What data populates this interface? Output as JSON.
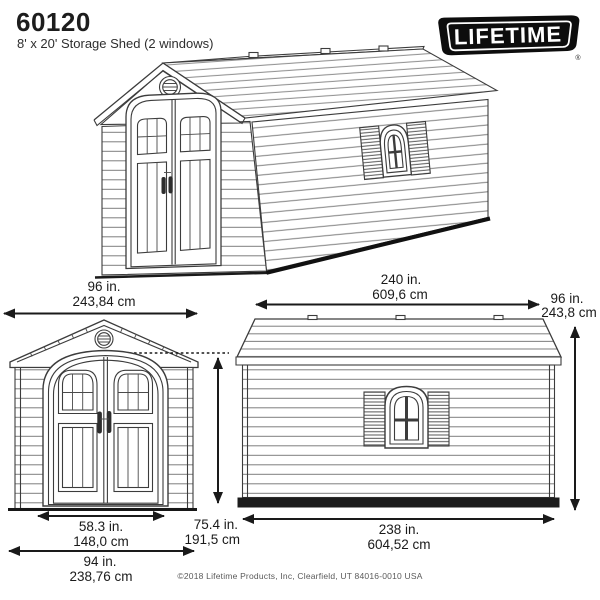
{
  "header": {
    "model_number": "60120",
    "product_name": "8' x 20' Storage Shed (2 windows)",
    "brand_logo_text": "LIFETIME",
    "registered_symbol": "®"
  },
  "views": {
    "perspective": {
      "front_width": {
        "inches": "96 in.",
        "centimeters": "243,84 cm"
      },
      "side_length": {
        "inches": "240 in.",
        "centimeters": "609,6 cm"
      }
    },
    "front_elevation": {
      "door_width": {
        "inches": "58.3 in.",
        "centimeters": "148,0 cm"
      },
      "door_height": {
        "inches": "75.4 in.",
        "centimeters": "191,5 cm"
      },
      "base_width": {
        "inches": "94 in.",
        "centimeters": "238,76 cm"
      }
    },
    "side_elevation": {
      "height": {
        "inches": "96 in.",
        "centimeters": "243,8 cm"
      },
      "base_length": {
        "inches": "238 in.",
        "centimeters": "604,52 cm"
      }
    }
  },
  "footer": {
    "copyright": "©2018 Lifetime Products, Inc, Clearfield, UT 84016-0010 USA"
  },
  "colors": {
    "line_art": "#3c3c3c",
    "dimension_ink": "#1a1a1a",
    "logo_background": "#0d0d0d",
    "logo_text": "#ffffff",
    "page_background": "#ffffff"
  }
}
